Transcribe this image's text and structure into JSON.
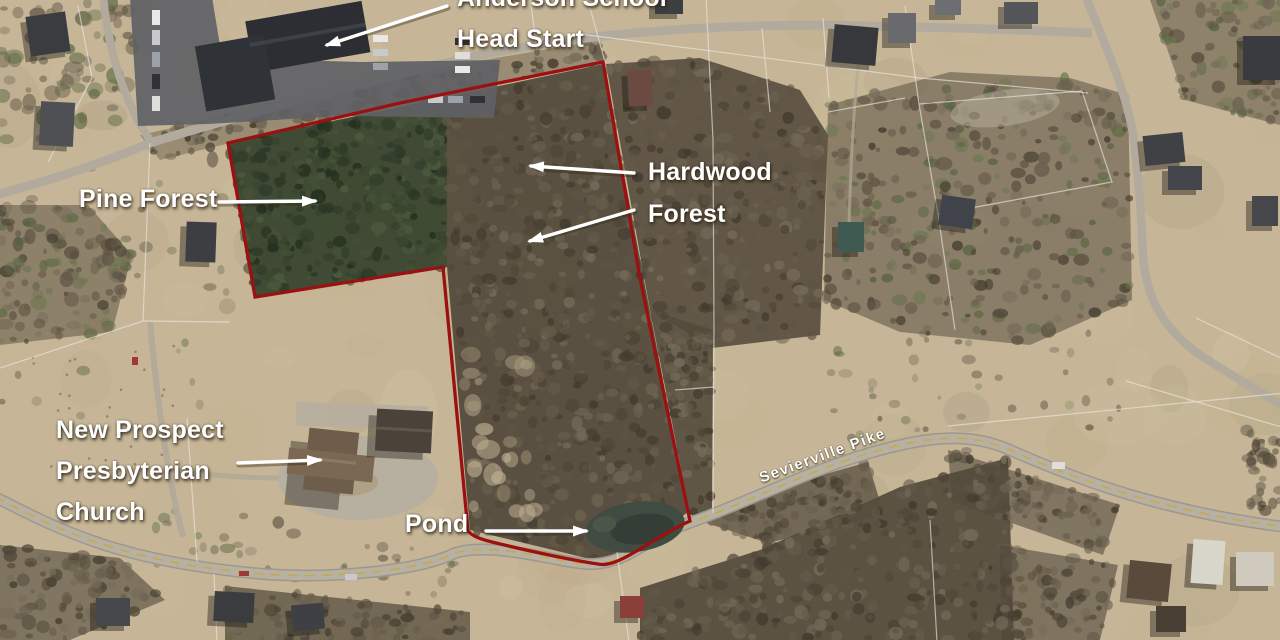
{
  "map": {
    "annotations": {
      "school_line1": "Anderson School",
      "school_line2": "Head Start",
      "pine_forest": "Pine Forest",
      "hardwood_line1": "Hardwood",
      "hardwood_line2": "Forest",
      "church_line1": "New Prospect",
      "church_line2": "Presbyterian",
      "church_line3": "Church",
      "pond": "Pond",
      "road_label": "Sevierville Pike"
    },
    "colors": {
      "property_boundary": "#9b1111",
      "annotation_text": "#ffffff",
      "road_centerline": "#c9a84c"
    }
  }
}
